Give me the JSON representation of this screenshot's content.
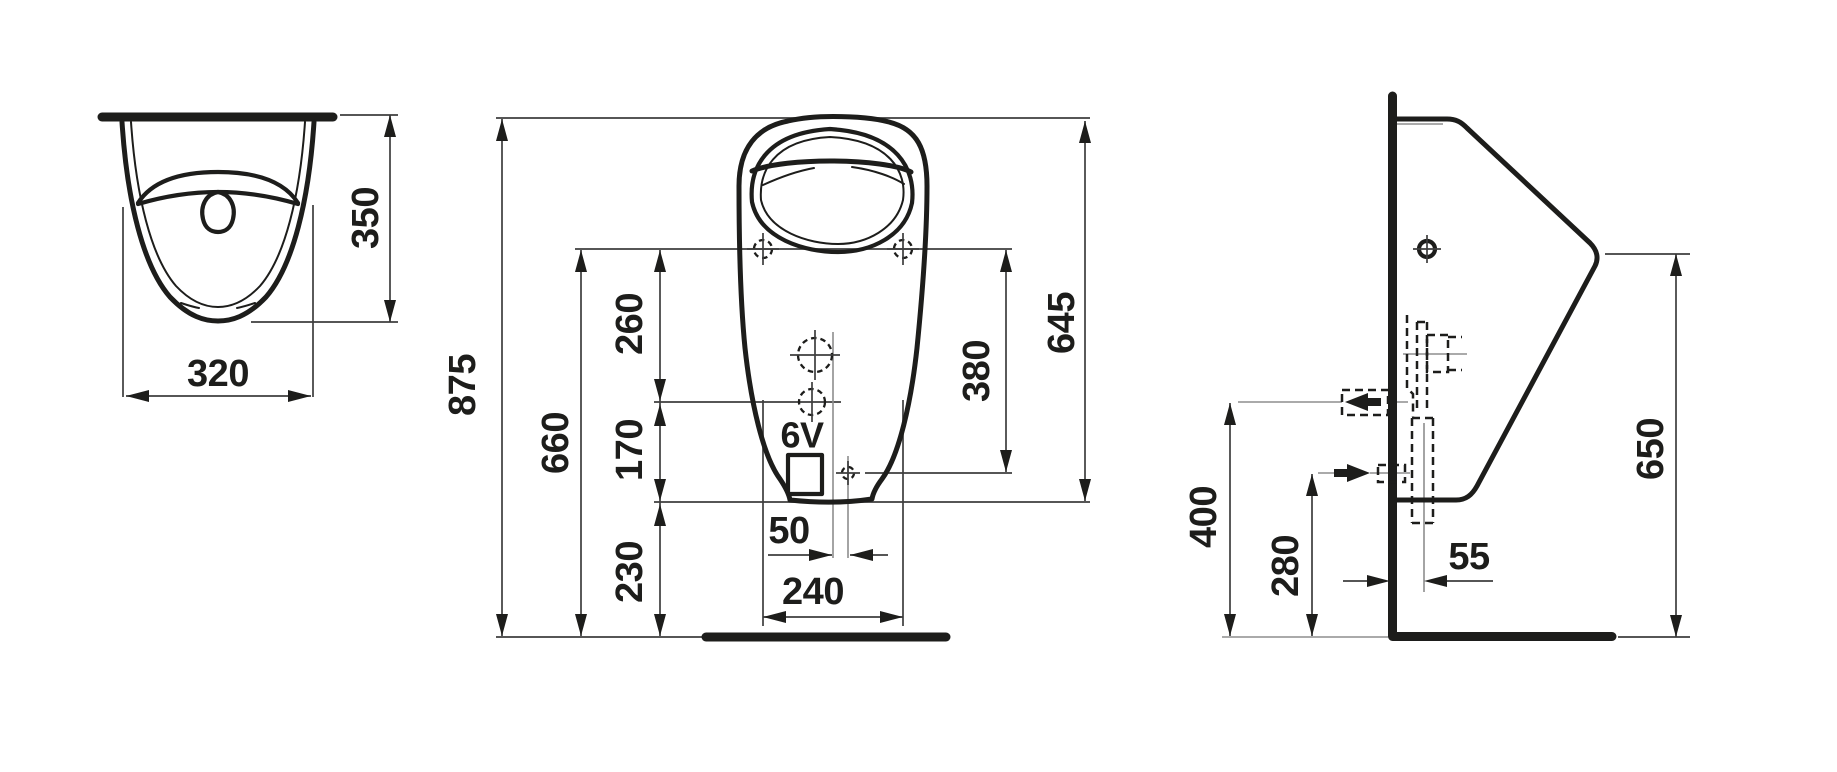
{
  "drawing": {
    "line_color": "#1d1d1b",
    "background": "#ffffff"
  },
  "top_view": {
    "width": "320",
    "depth": "350"
  },
  "front_view": {
    "total_height": "875",
    "floor_to_mounting_holes": "660",
    "mounting_holes_to_inlet": "260",
    "inlet_to_bottom_edge": "170",
    "bottom_edge_to_floor": "230",
    "outlet_offset": "50",
    "mounting_hole_spacing": "240",
    "mounting_holes_to_outlet": "380",
    "top_to_bottom_edge": "645",
    "battery_label": "6V"
  },
  "side_view": {
    "inlet_height": "400",
    "outlet_height": "280",
    "outlet_distance_from_wall": "55",
    "rim_front_height": "650"
  }
}
